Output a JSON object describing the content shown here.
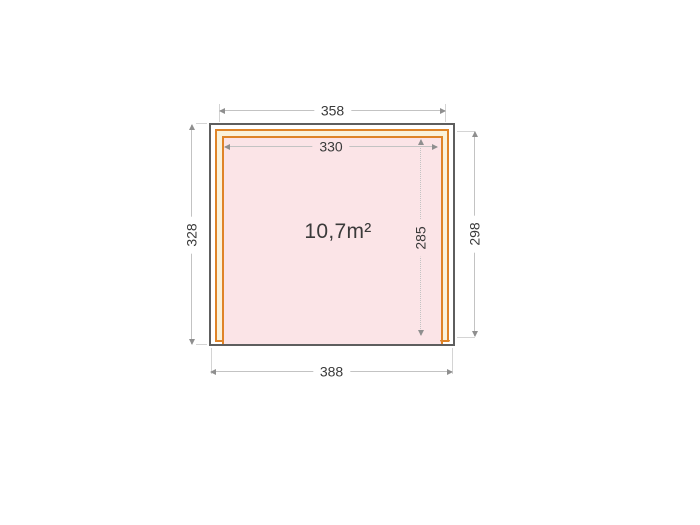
{
  "diagram": {
    "title": "garden-house floor plan",
    "area_label": "10,7m²",
    "dims": {
      "top_width": "358",
      "inner_width": "330",
      "left_depth": "328",
      "right_depth": "298",
      "inner_depth": "285",
      "bottom_width": "388"
    },
    "colors": {
      "wall_outline": "#5e5e5e",
      "frame_orange": "#df8428",
      "frame_fill": "#faf2db",
      "floor_fill": "#fbe4e7",
      "dim_line": "#c3c3c3",
      "dim_arrow": "#8f8f8f",
      "ext_line": "#d4d4d4",
      "text": "#3a3a3a"
    }
  }
}
